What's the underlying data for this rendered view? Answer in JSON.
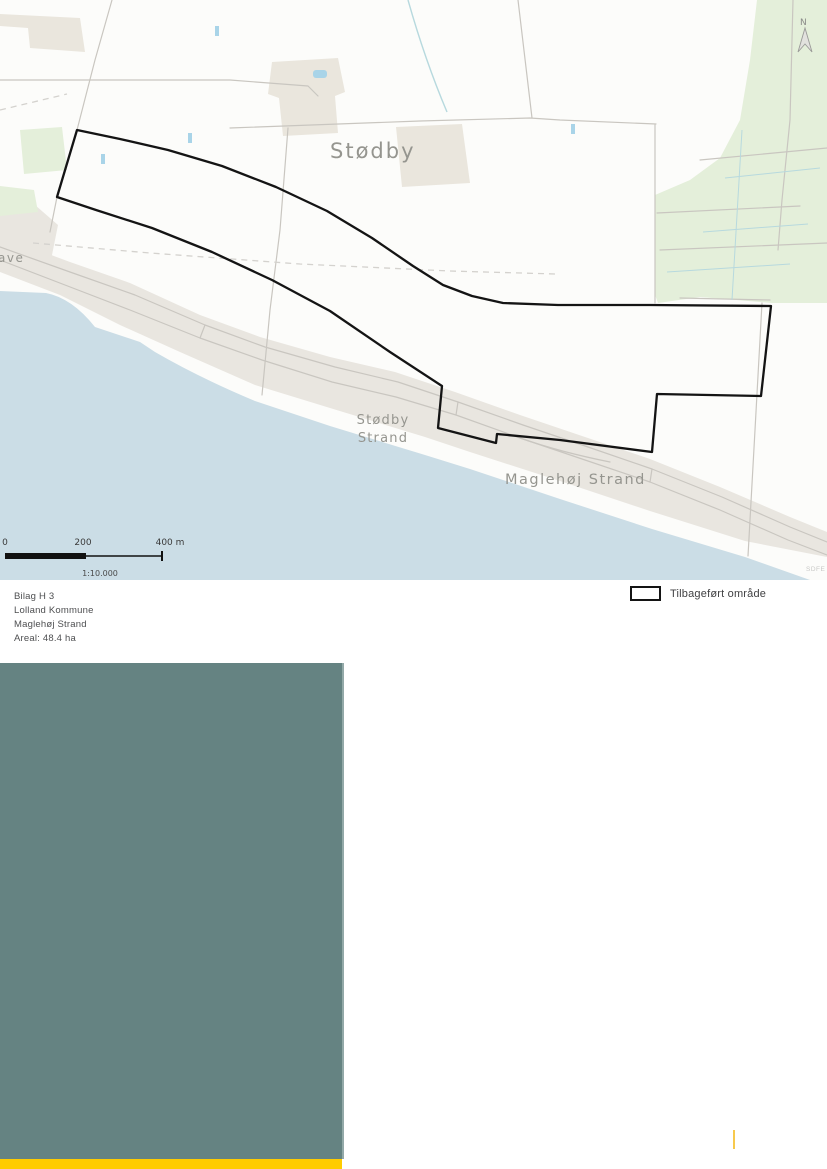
{
  "map": {
    "labels": {
      "town": "Stødby",
      "shore_settlement_line1": "Stødby",
      "shore_settlement_line2": "Strand",
      "shore_settlement2": "Maglehøj Strand",
      "left_edge_fragment": "ave",
      "north_letter": "N",
      "attribution": "SDFE"
    },
    "scalebar": {
      "start": "0",
      "mid": "200",
      "end": "400 m",
      "ratio": "1:10.000"
    }
  },
  "caption": {
    "lines": [
      "Bilag H 3",
      "Lolland Kommune",
      "Maglehøj Strand",
      "Areal: 48.4 ha"
    ]
  },
  "legend": {
    "restored_area_label": "Tilbageført område"
  },
  "colors": {
    "land": "#fcfcfa",
    "sea": "#cbdde6",
    "coast_strip": "#e9e6e0",
    "village": "#eae6dd",
    "vegetation": "#e4efda",
    "road": "#c9c6c0",
    "ditch": "#b7d9de",
    "pond": "#a9d4e8",
    "dashed_boundary": "#d4d2ce",
    "outline": "#141414",
    "map_label": "#95958f",
    "info_text": "#4e4f51",
    "legend_text": "#3f3f41",
    "teal_panel": "#658382",
    "footer_yellow": "#ffcc00",
    "page_mark_yellow": "#f7c94d"
  }
}
